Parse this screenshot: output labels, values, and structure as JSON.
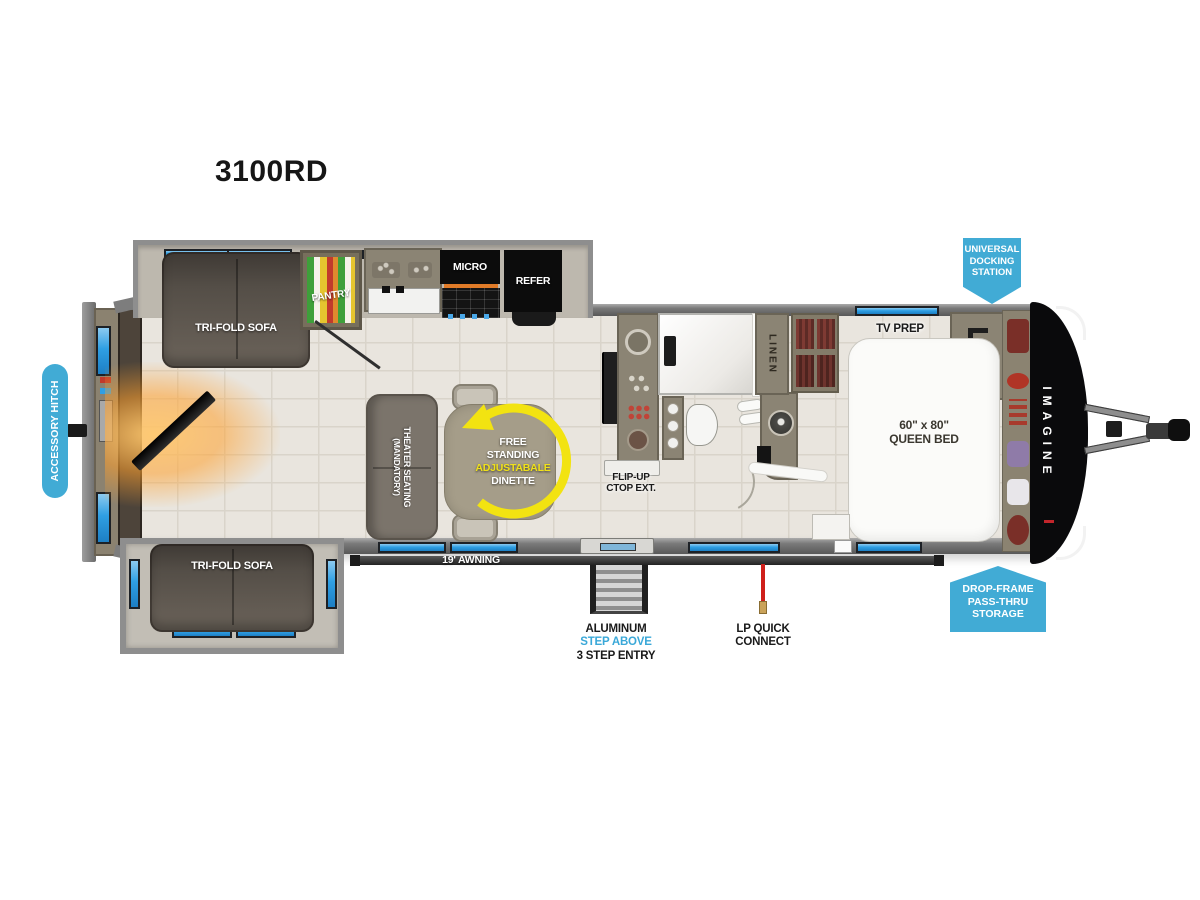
{
  "title": "3100RD",
  "brand_logo": "IMAGINE",
  "colors": {
    "badge_blue": "#41ABD5",
    "window_blue": "#2F9FE3",
    "arrow_yellow": "#F2E311",
    "lp_red": "#CF1F1A"
  },
  "badges": {
    "accessory_hitch": "ACCESSORY HITCH",
    "universal_docking": {
      "line1": "UNIVERSAL",
      "line2": "DOCKING",
      "line3": "STATION"
    },
    "drop_frame_storage": {
      "line1": "DROP-FRAME",
      "line2": "PASS-THRU",
      "line3": "STORAGE"
    }
  },
  "living_area": {
    "sofa_top": "TRI-FOLD SOFA",
    "sofa_bottom": "TRI-FOLD SOFA",
    "theater_seating": {
      "line1": "THEATER SEATING",
      "line2": "(MANDATORY)"
    },
    "dinette": {
      "line1": "FREE",
      "line2": "STANDING",
      "line3": "ADJUSTABALE",
      "line4": "DINETTE"
    }
  },
  "kitchen": {
    "pantry": "PANTRY",
    "microwave": "MICRO",
    "refrigerator": "REFER",
    "flip_up_counter": {
      "line1": "FLIP-UP",
      "line2": "CTOP EXT."
    }
  },
  "bathroom": {
    "linen": "LINEN"
  },
  "bedroom": {
    "tv_prep": "TV PREP",
    "bed": {
      "line1": "60\" x 80\"",
      "line2": "QUEEN BED"
    }
  },
  "exterior": {
    "awning": "19' AWNING",
    "entry_steps": {
      "line1": "ALUMINUM",
      "line2": "STEP ABOVE",
      "line3": "3 STEP ENTRY"
    },
    "lp_connect": {
      "line1": "LP QUICK",
      "line2": "CONNECT"
    }
  }
}
